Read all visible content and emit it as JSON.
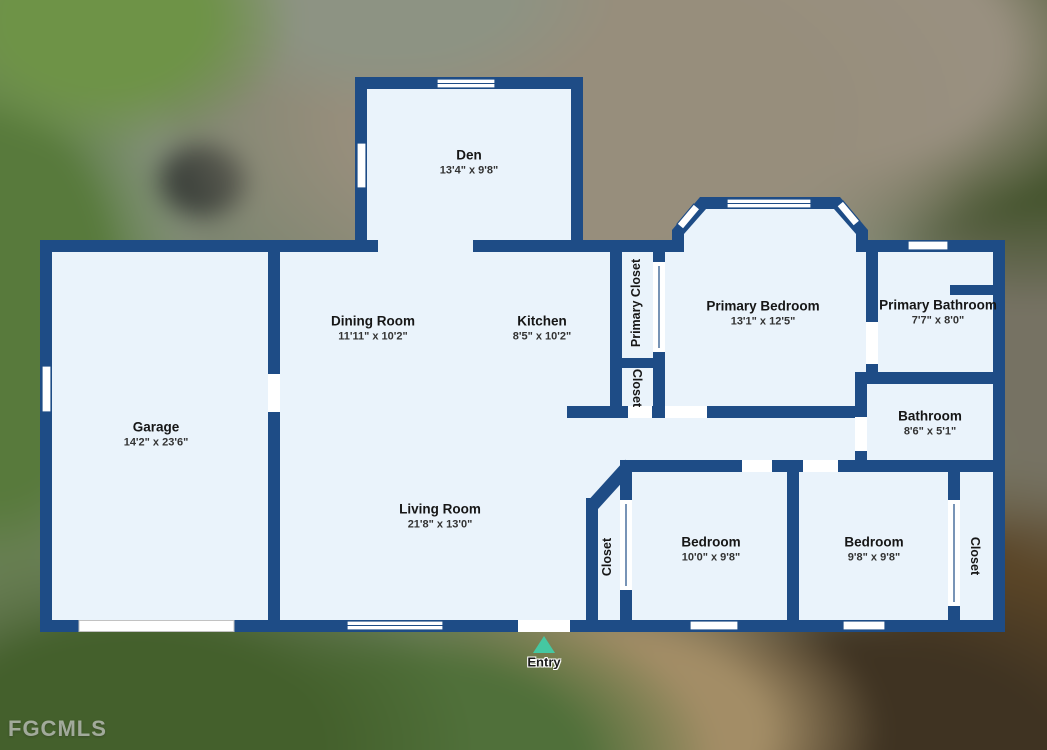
{
  "floorplan": {
    "rooms": [
      {
        "name": "Den",
        "dims": "13'4\" x 9'8\""
      },
      {
        "name": "Dining Room",
        "dims": "11'11\" x 10'2\""
      },
      {
        "name": "Kitchen",
        "dims": "8'5\" x 10'2\""
      },
      {
        "name": "Primary Closet",
        "dims": ""
      },
      {
        "name": "Closet",
        "dims": ""
      },
      {
        "name": "Primary Bedroom",
        "dims": "13'1\" x 12'5\""
      },
      {
        "name": "Primary Bathroom",
        "dims": "7'7\" x 8'0\""
      },
      {
        "name": "Bathroom",
        "dims": "8'6\" x 5'1\""
      },
      {
        "name": "Garage",
        "dims": "14'2\" x 23'6\""
      },
      {
        "name": "Living Room",
        "dims": "21'8\" x 13'0\""
      },
      {
        "name": "Closet",
        "dims": ""
      },
      {
        "name": "Bedroom",
        "dims": "10'0\" x 9'8\""
      },
      {
        "name": "Bedroom",
        "dims": "9'8\" x 9'8\""
      },
      {
        "name": "Closet",
        "dims": ""
      }
    ],
    "entry_label": "Entry",
    "colors": {
      "wall": "#1e4c86",
      "floor": "#eaf3fb",
      "entry_marker": "#45c8a2",
      "label_text": "#161616"
    }
  },
  "icons": {
    "entry_marker": "triangle-up"
  },
  "watermark": "FGCMLS"
}
